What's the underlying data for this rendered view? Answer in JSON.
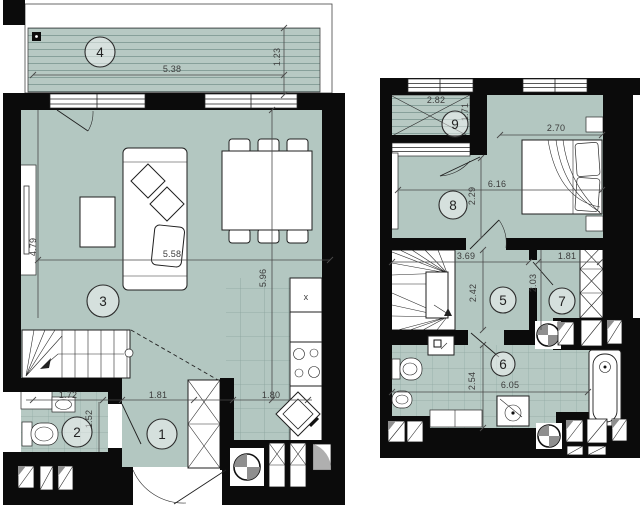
{
  "title": "Two-level apartment floor plan",
  "colors": {
    "floor": "#b3c7c1",
    "wall": "#0b0b0b",
    "dim_text": "#3c3c3c",
    "paper": "#ffffff"
  },
  "floor1": {
    "room_numbers": [
      "1",
      "2",
      "3",
      "4"
    ],
    "dims": {
      "balcony_width": "5.38",
      "balcony_depth": "1.23",
      "living_depth": "4.79",
      "living_width": "5.58",
      "kitchen_depth": "5.96",
      "wc_width": "1.72",
      "wc_depth": "1.52",
      "hall_width": "1.81",
      "kitchen_width": "1.80"
    },
    "fixture_labels": {
      "cabinet_x": "x"
    }
  },
  "floor2": {
    "room_numbers": [
      "5",
      "6",
      "7",
      "8",
      "9"
    ],
    "dims": {
      "balcony_width": "2.82",
      "balcony_depth": "1.71",
      "bedroom_right_width": "2.70",
      "bedroom_total_width": "6.16",
      "bedroom_left_depth": "2.29",
      "hall_width": "3.69",
      "hall_depth": "2.42",
      "wardrobe_width": "1.81",
      "wardrobe_depth": "2.03",
      "bath_depth": "2.54",
      "bath_width": "6.05"
    }
  }
}
